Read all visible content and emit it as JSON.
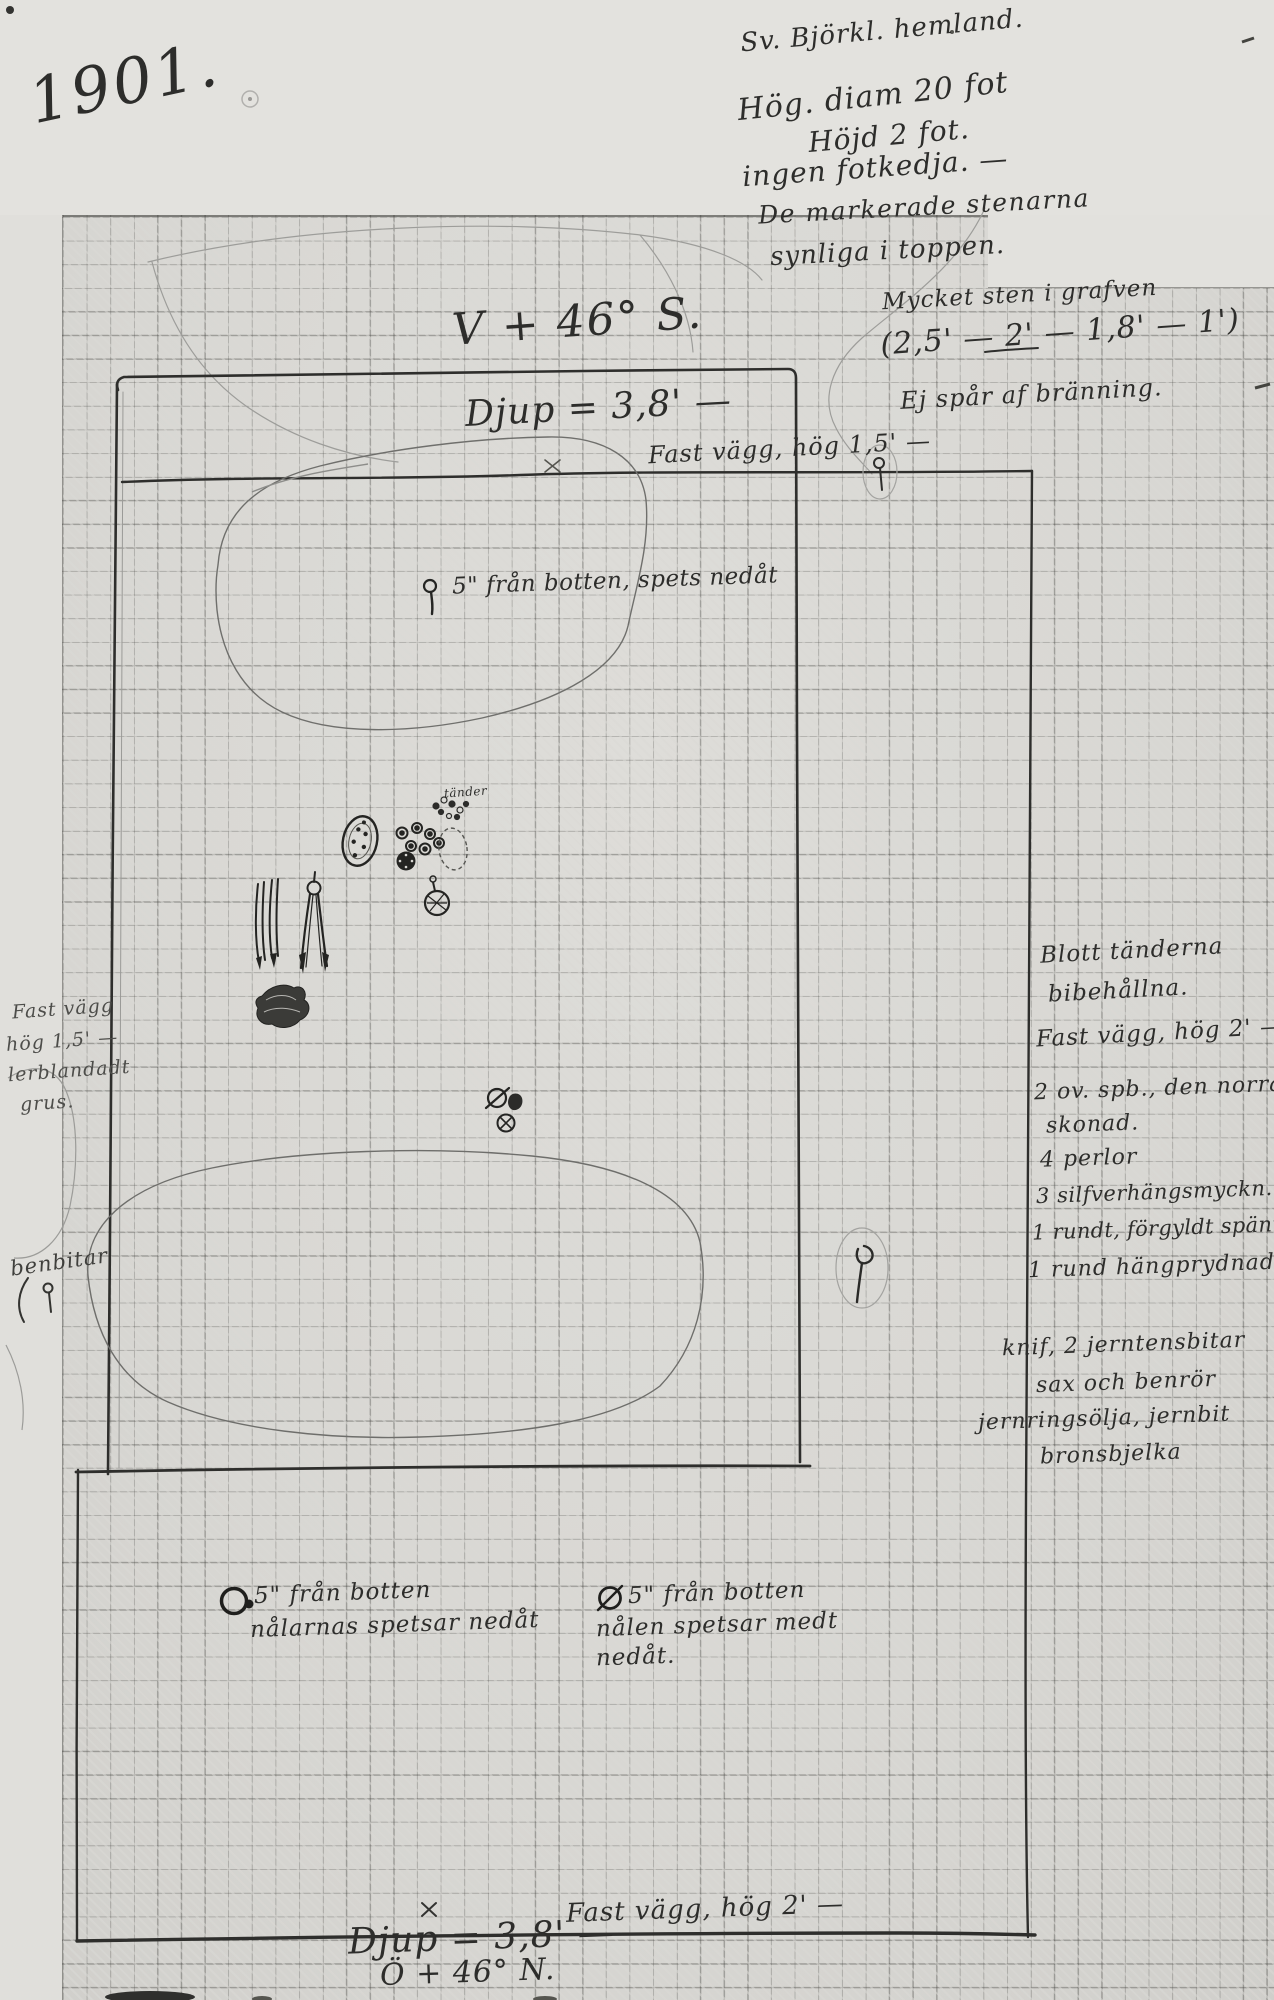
{
  "document": {
    "year": "1901.",
    "top_right_notes": [
      "Sv. Björkl. hemland.",
      "Hög. diam 20 fot",
      "Höjd 2 fot.",
      "ingen fotkedja. —",
      "De markerade stenarna",
      "synliga i toppen.",
      "Mycket sten i grafven",
      "(2,5' — 2' — 1,8' — 1')",
      "Ej spår af bränning."
    ],
    "plan": {
      "orientation_top": "V + 46° S.",
      "depth_top": "Djup = 3,8' —",
      "wall_top": "Fast vägg, hög 1,5' —",
      "spike_note": "5\" från botten, spets nedåt",
      "teeth_label": "tänder",
      "orientation_bottom": "Ö + 46° N.",
      "depth_bottom": "Djup = 3,8' —",
      "wall_bottom": "Fast vägg, hög 2' —",
      "needle_note_left": [
        "5\" från botten",
        "nålarnas spetsar nedåt"
      ],
      "needle_note_right": [
        "5\" från botten",
        "nålen spetsar medt",
        "nedåt."
      ]
    },
    "left_margin_notes": {
      "wall": [
        "Fast vägg",
        "hög 1,5' —",
        "lerblandadt",
        "grus."
      ],
      "bones": "benbitar"
    },
    "right_margin_notes": {
      "teeth": [
        "Blott tänderna",
        "bibehållna."
      ],
      "wall": "Fast vägg, hög 2' —",
      "finds": [
        "2 ov. spb., den norra",
        "skonad.",
        "4 perlor",
        "3 silfverhängsmyckn.",
        "1 rundt, förgyldt spänne",
        "1 rund hängprydnad"
      ],
      "tools": [
        "knif, 2 jerntensbitar",
        "sax och benrör",
        "jernringsölja, jernbit",
        "bronsbjelka"
      ]
    }
  }
}
